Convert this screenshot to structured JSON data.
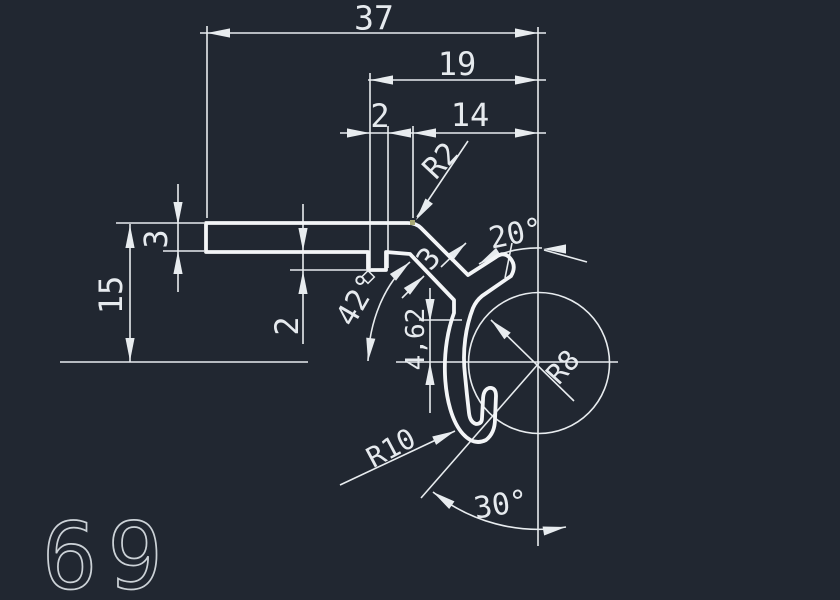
{
  "app": {
    "background_color": "#212731",
    "line_color": "#e8ecef",
    "profile_line_color": "#f3f5f7",
    "text_color": "#e6eaee",
    "sheet_number_color": "#ccd2d7"
  },
  "drawing": {
    "type": "CAD profile cross-section with dimensions",
    "sheet_number": "69",
    "dimensions": {
      "total_width": "37",
      "upper_width": "19",
      "notch_width": "2",
      "right_width": "14",
      "corner_radius": "R2",
      "arm_angle": "20°",
      "strip_thickness": "3",
      "overall_height": "15",
      "notch_depth": "2",
      "stem_angle": "42°",
      "stem_thickness": "3",
      "center_offset": "4,62",
      "circle_radius": "R8",
      "hook_radius": "R10",
      "bottom_angle": "30°"
    }
  }
}
